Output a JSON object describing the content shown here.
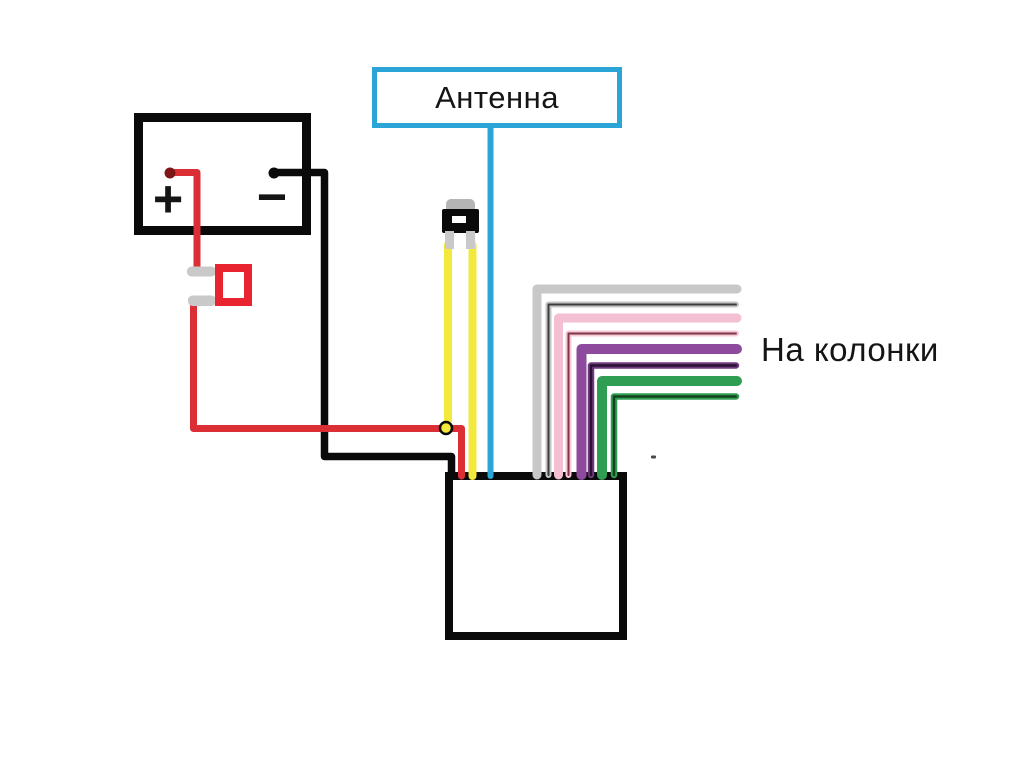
{
  "diagram": {
    "antenna_label": "Антенна",
    "speakers_label": "На колонки",
    "battery_plus": "+",
    "battery_minus": "−"
  },
  "colors": {
    "line_black": "#0a0a0a",
    "power_red": "#dc2f35",
    "fuse_red": "#e82430",
    "terminal_dark_red": "#7e1616",
    "antenna_blue": "#2ba4d8",
    "accessory_yellow": "#f3e83c",
    "connector_gray": "#c9c9c9",
    "connector_cap_gray": "#b5b5b5",
    "connector_window_white": "#ffffff",
    "box_fill_white": "#ffffff",
    "stray_gray": "#4a4a4a"
  },
  "speaker_wires": [
    {
      "name": "gray",
      "color": "#c8c8c8"
    },
    {
      "name": "gray-black",
      "color": "#c4c4c4",
      "core": "#3b3b3b"
    },
    {
      "name": "pink",
      "color": "#f4bed3"
    },
    {
      "name": "pink-black",
      "color": "#f6c8d8",
      "core": "#7c3644"
    },
    {
      "name": "purple",
      "color": "#8e4b9d"
    },
    {
      "name": "purple-black",
      "color": "#6f3a7e",
      "core": "#2a1233"
    },
    {
      "name": "green",
      "color": "#2f9e53"
    },
    {
      "name": "green-black",
      "color": "#2f9e53",
      "core": "#16421f"
    }
  ]
}
